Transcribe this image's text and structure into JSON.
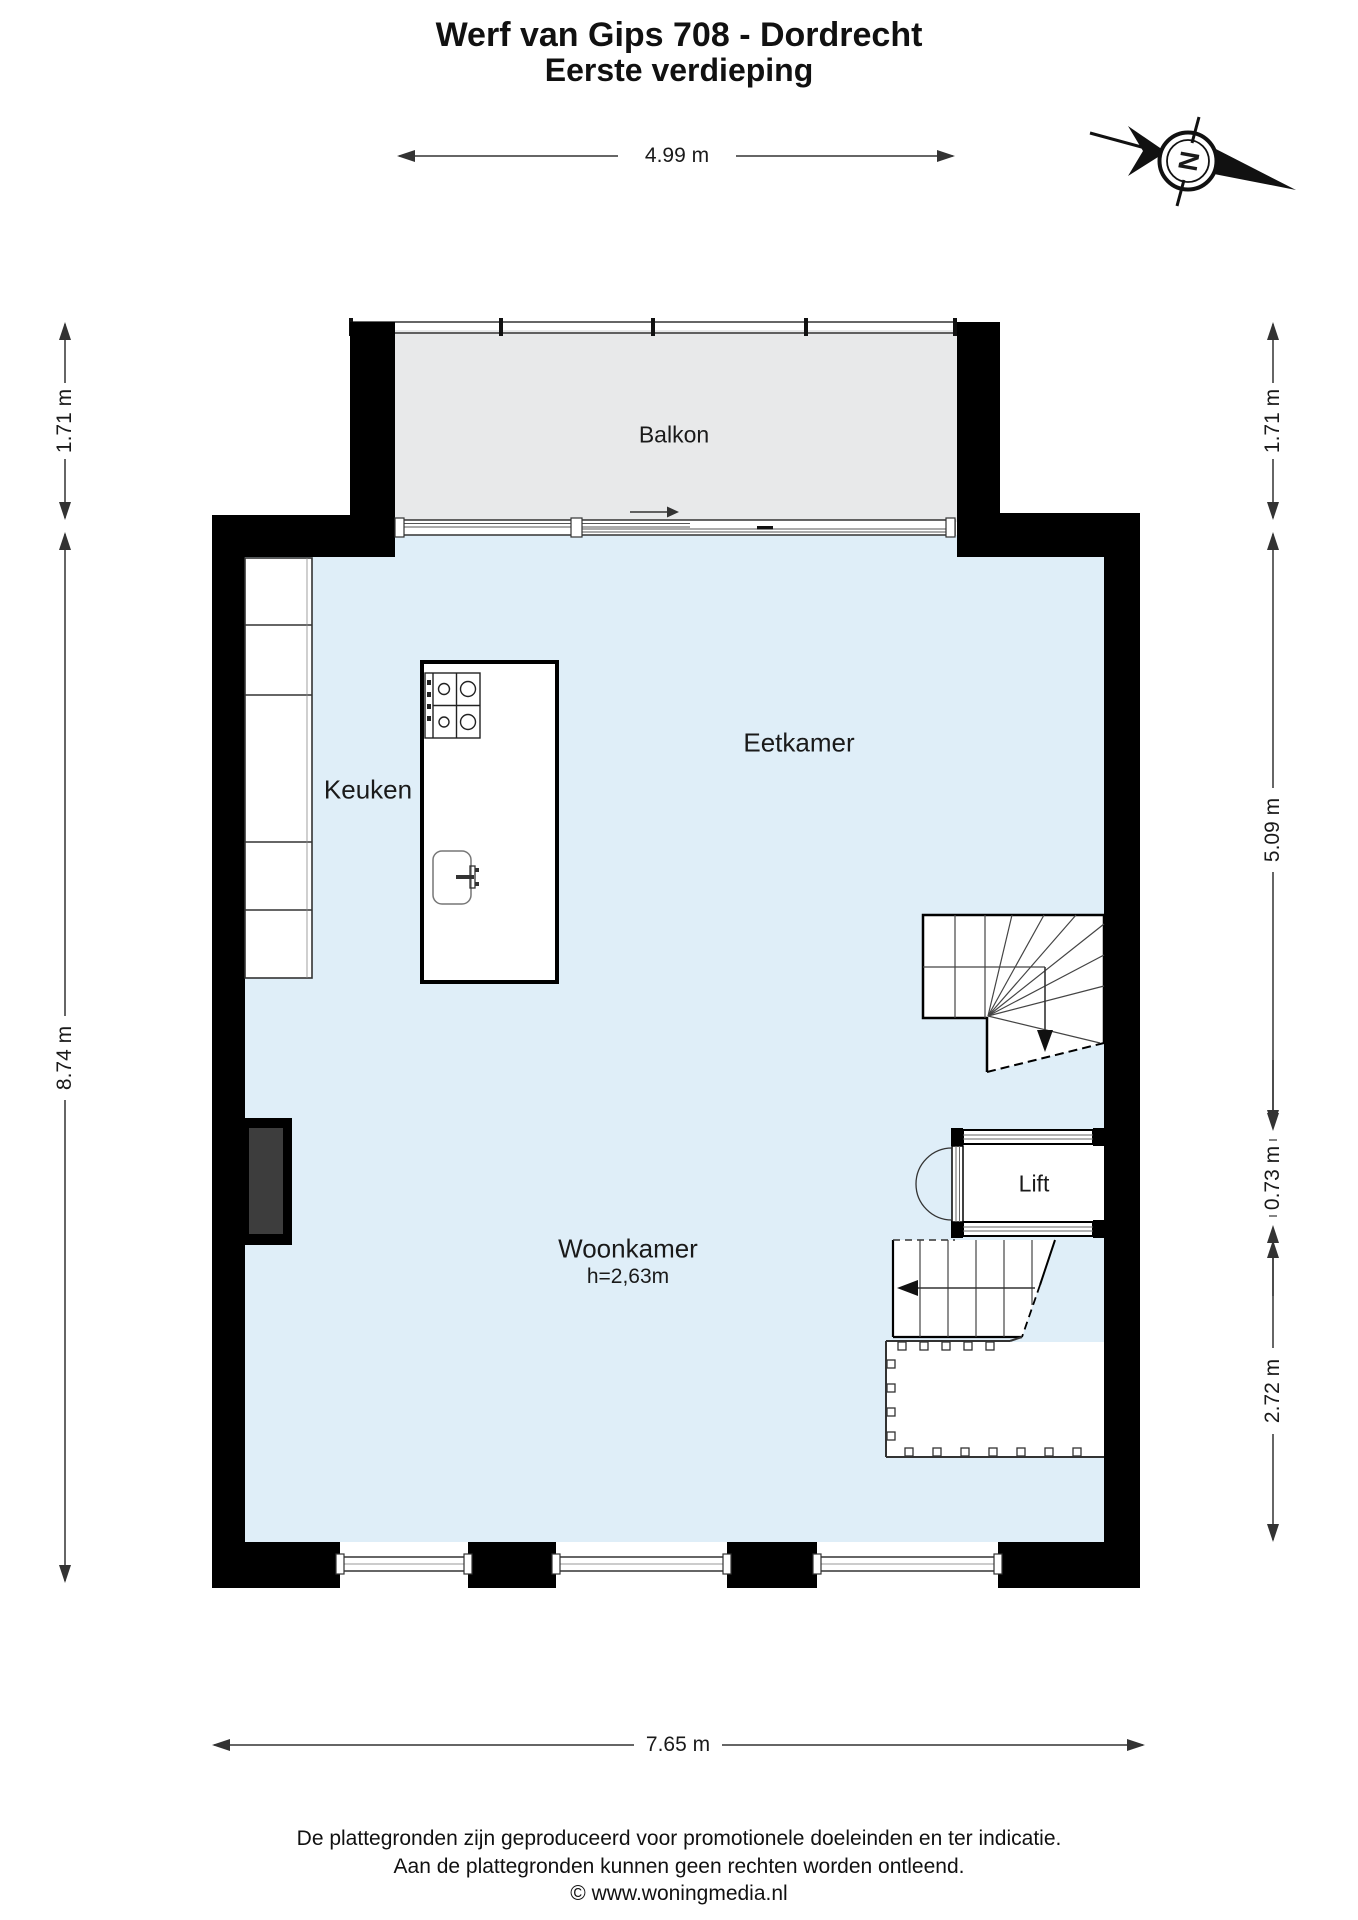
{
  "title": {
    "line1": "Werf van Gips 708 - Dordrecht",
    "line2": "Eerste verdieping"
  },
  "compass": {
    "north_label": "N"
  },
  "rooms": {
    "balkon": "Balkon",
    "keuken": "Keuken",
    "eetkamer": "Eetkamer",
    "woonkamer": "Woonkamer",
    "woonkamer_height": "h=2,63m",
    "lift": "Lift"
  },
  "dimensions": {
    "top_width": "4.99 m",
    "left_balcony_depth": "1.71 m",
    "left_room_depth": "8.74 m",
    "right_balcony_depth": "1.71 m",
    "right_upper": "5.09 m",
    "right_lift": "0.73 m",
    "right_lower": "2.72 m",
    "bottom_width": "7.65 m"
  },
  "footer": {
    "line1": "De plattegronden zijn geproduceerd voor promotionele doeleinden en ter indicatie.",
    "line2": "Aan de plattegronden kunnen geen rechten worden ontleend.",
    "line3": "© www.woningmedia.nl"
  },
  "colors": {
    "floor": "#dfeef8",
    "balcony": "#e8e9ea",
    "wall": "#000000",
    "chimney_fill": "#3d3d3d",
    "line": "#333333"
  }
}
